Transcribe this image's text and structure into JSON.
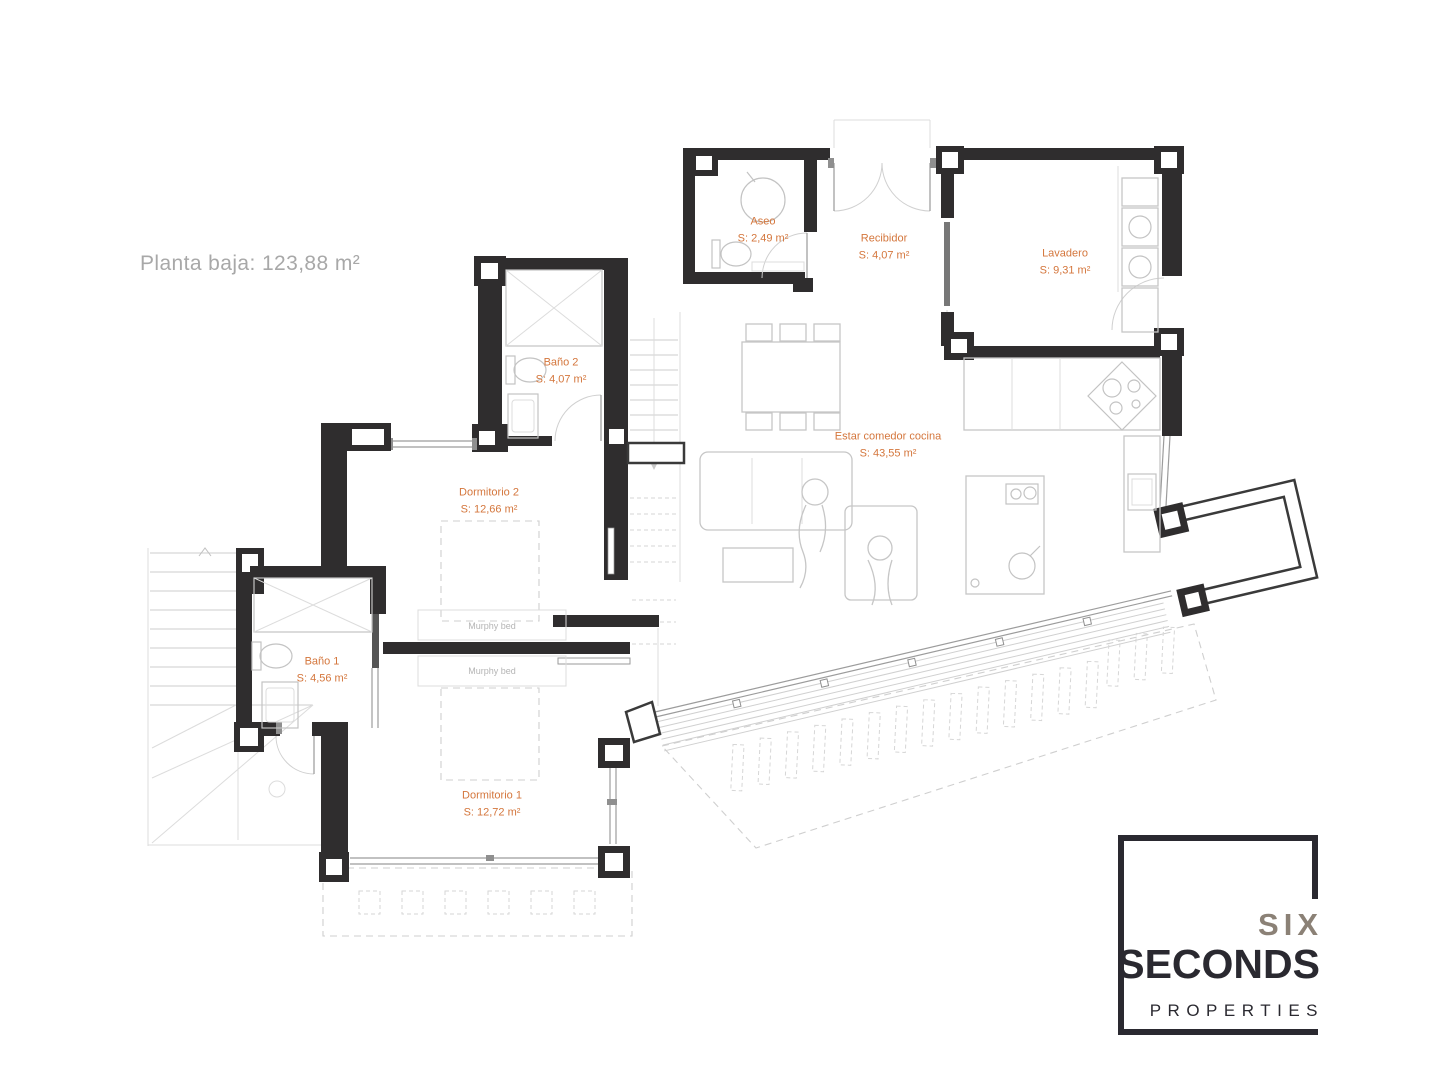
{
  "title": "Planta baja: 123,88 m²",
  "colors": {
    "label_orange": "#d4763c",
    "title_gray": "#a8a8a8",
    "wall_black": "#2f2d2e",
    "logo_dark": "#2a2930",
    "logo_gray": "#8b8176"
  },
  "rooms": [
    {
      "name": "Aseo",
      "area": "S: 2,49 m²"
    },
    {
      "name": "Recibidor",
      "area": "S: 4,07 m²"
    },
    {
      "name": "Lavadero",
      "area": "S: 9,31 m²"
    },
    {
      "name": "Baño 2",
      "area": "S: 4,07 m²"
    },
    {
      "name": "Dormitorio 2",
      "area": "S: 12,66 m²"
    },
    {
      "name": "Estar comedor cocina",
      "area": "S: 43,55 m²"
    },
    {
      "name": "Baño 1",
      "area": "S: 4,56 m²"
    },
    {
      "name": "Dormitorio 1",
      "area": "S: 12,72 m²"
    }
  ],
  "annotations": {
    "murphy_bed_1": "Murphy bed",
    "murphy_bed_2": "Murphy bed"
  },
  "logo": {
    "six": "SIX",
    "seconds": "SECONDS",
    "properties": "PROPERTIES"
  }
}
